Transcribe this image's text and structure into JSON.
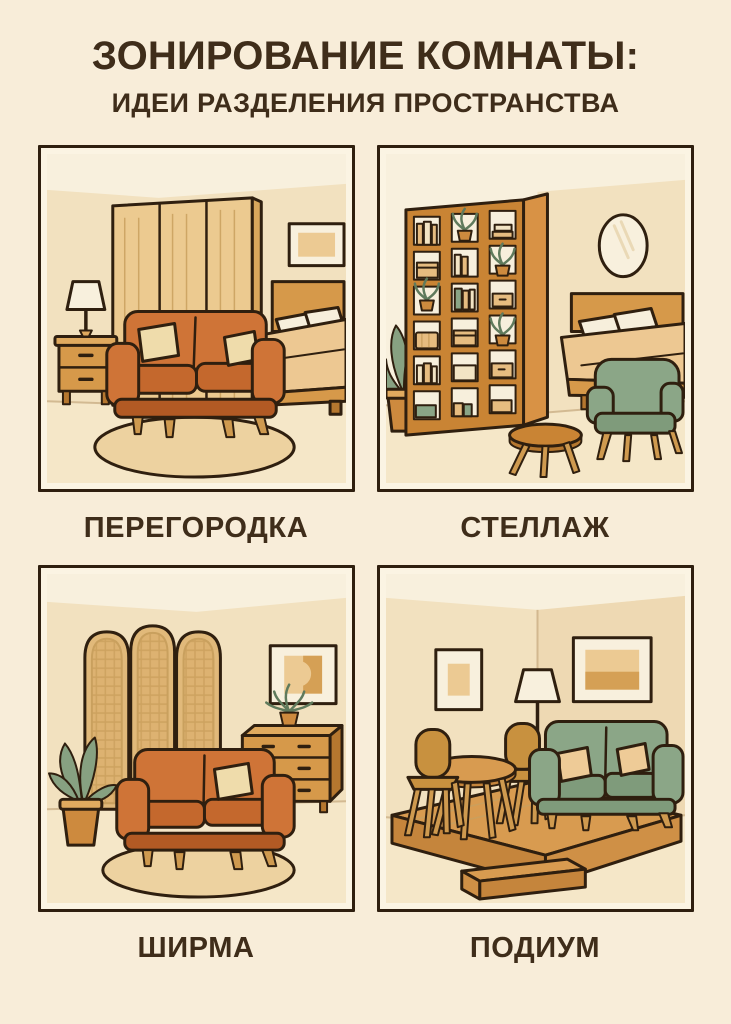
{
  "poster": {
    "title": "ЗОНИРОВАНИЕ КОМНАТЫ:",
    "subtitle": "ИДЕИ РАЗДЕЛЕНИЯ ПРОСТРАНСТВА"
  },
  "panels": [
    {
      "id": "partition",
      "label": "ПЕРЕГОРОДКА",
      "alt": "room split by tall wooden partition: orange loveseat, nightstand with lamp, rug in front; bed and wall picture behind"
    },
    {
      "id": "shelving",
      "label": "СТЕЛЛАЖ",
      "alt": "open shelving unit with plants, books and boxes dividing bed zone with oval mirror from green armchair and round coffee table"
    },
    {
      "id": "screen",
      "label": "ШИРМА",
      "alt": "three-arch rattan folding screen behind orange loveseat, potted plant, dresser with plant and abstract wall art, rug"
    },
    {
      "id": "podium",
      "label": "ПОДИУМ",
      "alt": "raised wooden platform with green sofa, round dining table with two chairs, floor lamp, two wall pictures and a step"
    }
  ],
  "colors": {
    "page_bg": "#f8edd9",
    "ink": "#3f2d1a",
    "outline": "#2f1f0f",
    "panel_bg": "#fbf4e3",
    "ceiling": "#f8f0dd",
    "wall_mid": "#f2e1bf",
    "wall_right": "#eed9b3",
    "floor": "#f5e7c8",
    "floor_line": "#c4a87e",
    "rug": "#edd2a0",
    "orange": "#cf7437",
    "orange_mid": "#c4682d",
    "orange_dark": "#b25a24",
    "cream": "#efdcab",
    "white_soft": "#f7efdc",
    "blanket": "#edc892",
    "wood_mid": "#d6994a",
    "wood_top": "#e0aa5f",
    "wood_dark": "#b5772f",
    "panel_wood": "#ecca90",
    "wood_edge": "#d9a75c",
    "shelf_wood": "#c98434",
    "shelf_side": "#d89245",
    "book1": "#e6bc80",
    "book2": "#f2e4c4",
    "green_book": "#8aa586",
    "green": "#8ba687",
    "green_dark": "#7f9b7b",
    "leg": "#cf9a4f",
    "pot": "#cd8a3e",
    "chair": "#c8913f",
    "screen": "#e1b97a",
    "screen_line": "#c9a05e",
    "art1": "#ecca93",
    "art2": "#d5a055",
    "pillow2": "#eecb97",
    "podium_top": "#d89b50",
    "podium_front": "#c5853c",
    "podium_side": "#cf9046",
    "leaf_green": "#87a181",
    "leaf_line": "#5f7a5c"
  }
}
